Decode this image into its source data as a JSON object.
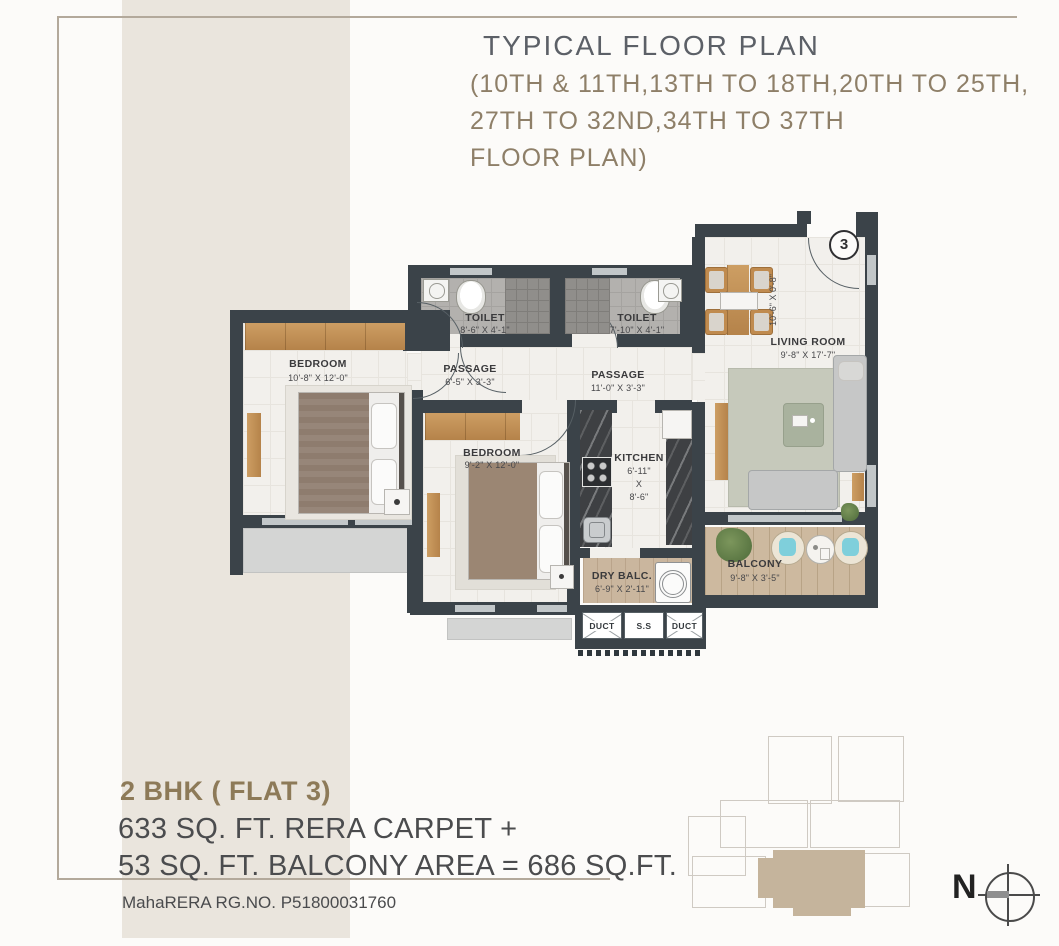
{
  "header": {
    "title": "TYPICAL FLOOR PLAN",
    "subtitle_line1": "(10TH & 11TH,13TH TO 18TH,20TH TO 25TH,",
    "subtitle_line2": "27TH TO 32ND,34TH TO 37TH",
    "subtitle_line3": "FLOOR PLAN)"
  },
  "plan": {
    "flat_badge": "3",
    "foyer_dim": "10'-6\" X 0'-8\"",
    "rooms": {
      "bedroom1": {
        "name": "BEDROOM",
        "dim": "10'-8\" X 12'-0\""
      },
      "bedroom2": {
        "name": "BEDROOM",
        "dim": "9'-2\" X 12'-0\""
      },
      "toilet1": {
        "name": "TOILET",
        "dim": "8'-6\" X 4'-1\""
      },
      "toilet2": {
        "name": "TOILET",
        "dim": "7'-10\" X 4'-1\""
      },
      "passage1": {
        "name": "PASSAGE",
        "dim": "6'-5\" X 3'-3\""
      },
      "passage2": {
        "name": "PASSAGE",
        "dim": "11'-0\" X 3'-3\""
      },
      "kitchen": {
        "name": "KITCHEN",
        "dim_line1": "6'-11\"",
        "dim_line2": "X",
        "dim_line3": "8'-6\""
      },
      "living": {
        "name": "LIVING ROOM",
        "dim": "9'-8\" X 17'-7\""
      },
      "dry_balcony": {
        "name": "DRY BALC.",
        "dim": "6'-9\" X 2'-11\""
      },
      "balcony": {
        "name": "BALCONY",
        "dim": "9'-8\" X 3'-5\""
      }
    },
    "ducts": {
      "left": "DUCT",
      "middle": "S.S",
      "right": "DUCT"
    }
  },
  "summary": {
    "unit_type": "2 BHK ( FLAT 3)",
    "area_line1": "633 SQ. FT. RERA CARPET +",
    "area_line2": "53 SQ. FT. BALCONY AREA = 686 SQ.FT.",
    "rera_no": "MahaRERA RG.NO.  P51800031760"
  },
  "compass": {
    "north_label": "N"
  },
  "colors": {
    "wall": "#3b4349",
    "band_beige": "#eae5dd",
    "title_gray": "#5c6067",
    "subtitle_brown": "#8e7f68",
    "accent_brown": "#8d7a58",
    "balcony_wood": "#cdb99f",
    "keyplan_highlight": "#c5b49c"
  }
}
